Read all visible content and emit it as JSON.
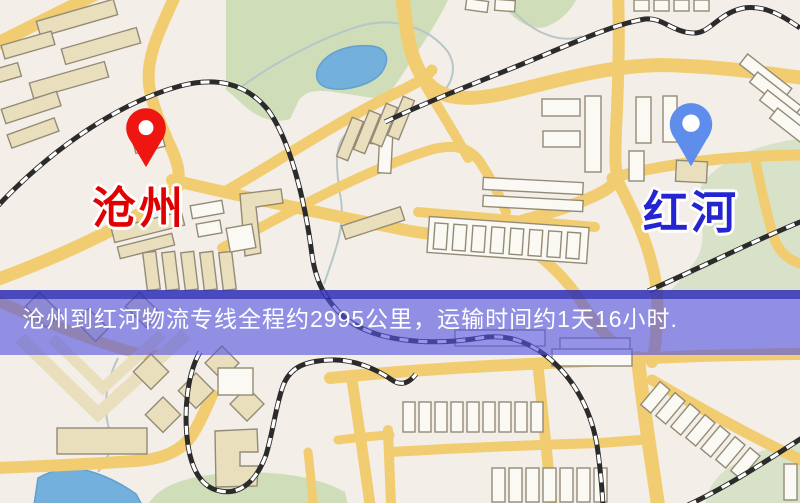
{
  "map": {
    "kind": "stylized-logistics-route-map",
    "origin": {
      "label": "沧州",
      "pin_color": "#ef1510",
      "label_color": "#e00000"
    },
    "destination": {
      "label": "红河",
      "pin_color": "#5e8deb",
      "label_color": "#2424d0"
    },
    "banner": {
      "text": "沧州到红河物流专线全程约2995公里，运输时间约1天16小时.",
      "text_color": "#ffffff",
      "body_color": "rgba(84,84,225,0.62)",
      "top_edge_color": "#2d2db5"
    },
    "colors": {
      "background": "#f3eee7",
      "road": "#f2cc70",
      "building_tan": "#eadfbd",
      "building_white": "#fbf9f3",
      "building_outline": "#948b77",
      "park": "#cfdeb8",
      "park2": "#d7e2c9",
      "water": "#74b0dc",
      "railway": "#2b2b2b",
      "stream": "#b7c6c9"
    }
  }
}
